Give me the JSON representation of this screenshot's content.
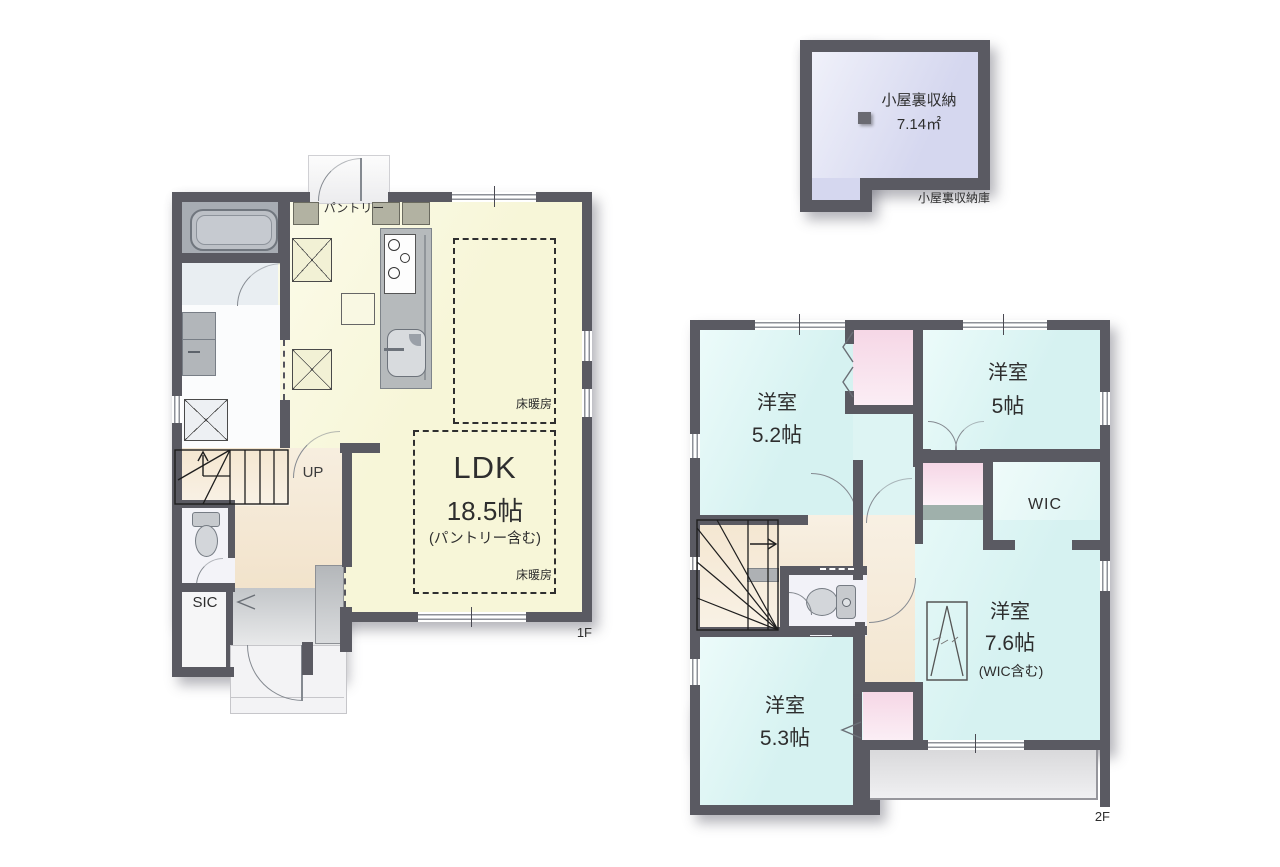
{
  "plan_type": "house-floor-plan",
  "floor1": {
    "floor_label": "1F",
    "ldk": {
      "name": "LDK",
      "size": "18.5帖",
      "note": "(パントリー含む)"
    },
    "pantry_label": "パントリー",
    "floor_heating_label": "床暖房",
    "stairs_label": "UP",
    "sic_label": "SIC"
  },
  "floor2": {
    "floor_label": "2F",
    "room_52": {
      "name": "洋室",
      "size": "5.2帖"
    },
    "room_5": {
      "name": "洋室",
      "size": "5帖"
    },
    "room_76": {
      "name": "洋室",
      "size": "7.6帖",
      "note": "(WIC含む)"
    },
    "room_53": {
      "name": "洋室",
      "size": "5.3帖"
    },
    "wic_label": "WIC"
  },
  "attic": {
    "name": "小屋裏収納",
    "area": "7.14㎡",
    "caption": "小屋裏収納庫"
  },
  "colors": {
    "wall": "#5a5a62",
    "ldk_floor": "#f7f6d8",
    "hall_floor": "#f2e3cb",
    "bedroom_floor": "#d6f2f1",
    "closet_fill": "#f6d7e6",
    "attic_fill": "#d5d7ef",
    "bath_fill": "#a7acb3",
    "balcony_fill": "#e0e0e2",
    "entrance_fill": "#c3c6c9"
  }
}
